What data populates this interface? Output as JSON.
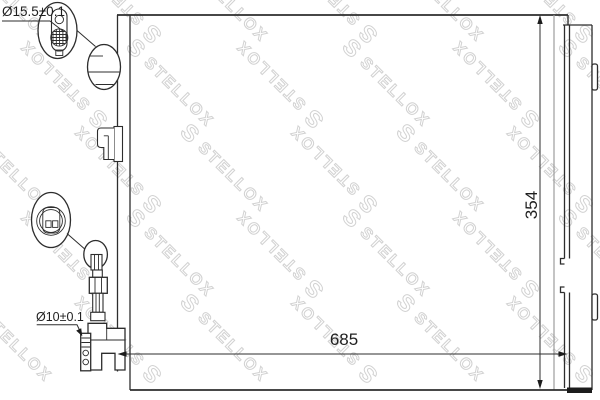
{
  "drawing": {
    "type": "technical-part-diagram",
    "part": "air-conditioning condenser with receiver drier",
    "dimensions": {
      "top_port_diameter": "Ø15.5±0.1",
      "bottom_port_diameter": "Ø10±0.1",
      "core_width": "685",
      "core_height": "354"
    }
  },
  "watermark": {
    "logo_char": "S",
    "text": "STELLOX",
    "color": "#d2d2d2"
  },
  "colors": {
    "background": "#ffffff",
    "line": "#2d2d2d",
    "secondary_line": "#9c9c9c"
  }
}
